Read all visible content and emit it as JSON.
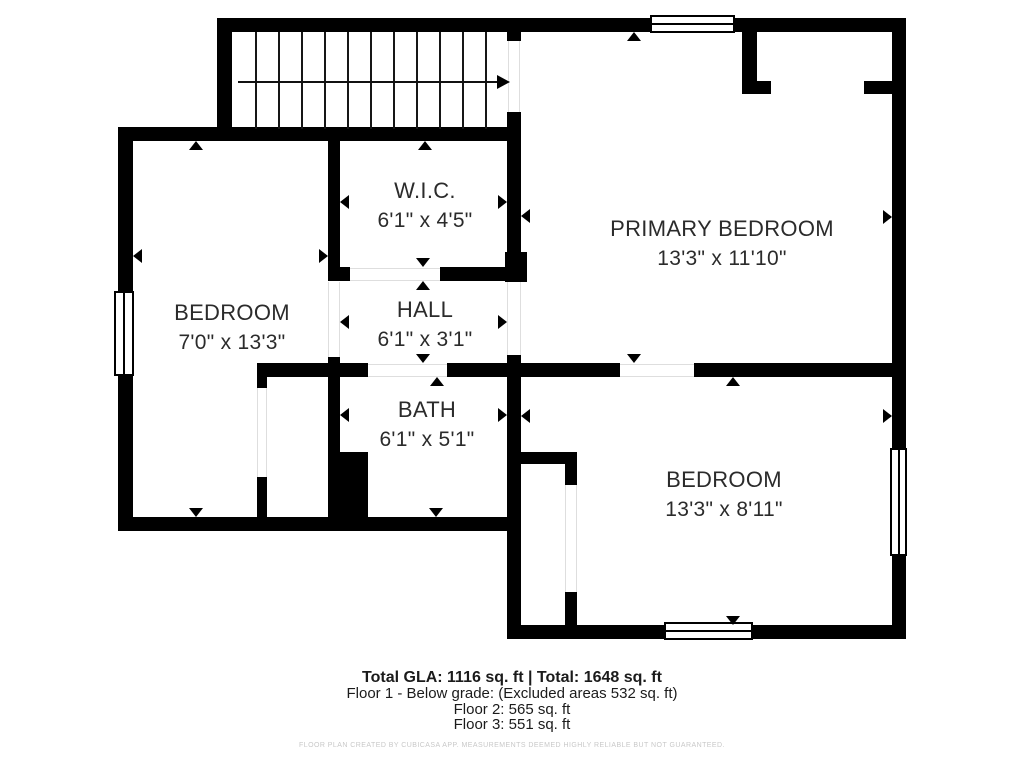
{
  "plan": {
    "rooms": [
      {
        "name": "W.I.C.",
        "dims": "6'1\" x 4'5\"",
        "cx": 425,
        "cy": 176
      },
      {
        "name": "PRIMARY BEDROOM",
        "dims": "13'3\" x 11'10\"",
        "cx": 722,
        "cy": 214
      },
      {
        "name": "BEDROOM",
        "dims": "7'0\" x 13'3\"",
        "cx": 232,
        "cy": 298
      },
      {
        "name": "HALL",
        "dims": "6'1\" x 3'1\"",
        "cx": 425,
        "cy": 295
      },
      {
        "name": "BATH",
        "dims": "6'1\" x 5'1\"",
        "cx": 427,
        "cy": 395
      },
      {
        "name": "BEDROOM",
        "dims": "13'3\" x 8'11\"",
        "cx": 724,
        "cy": 465
      }
    ],
    "walls": [
      {
        "x": 217,
        "y": 18,
        "w": 689,
        "h": 14
      },
      {
        "x": 892,
        "y": 18,
        "w": 14,
        "h": 621
      },
      {
        "x": 217,
        "y": 18,
        "w": 15,
        "h": 123
      },
      {
        "x": 118,
        "y": 127,
        "w": 392,
        "h": 14
      },
      {
        "x": 118,
        "y": 127,
        "w": 15,
        "h": 404
      },
      {
        "x": 118,
        "y": 517,
        "w": 402,
        "h": 14
      },
      {
        "x": 328,
        "y": 141,
        "w": 12,
        "h": 126
      },
      {
        "x": 328,
        "y": 267,
        "w": 22,
        "h": 14
      },
      {
        "x": 440,
        "y": 267,
        "w": 67,
        "h": 14
      },
      {
        "x": 505,
        "y": 252,
        "w": 22,
        "h": 30
      },
      {
        "x": 507,
        "y": 112,
        "w": 14,
        "h": 140
      },
      {
        "x": 507,
        "y": 32,
        "w": 14,
        "h": 9
      },
      {
        "x": 328,
        "y": 357,
        "w": 12,
        "h": 161
      },
      {
        "x": 328,
        "y": 452,
        "w": 40,
        "h": 66
      },
      {
        "x": 257,
        "y": 363,
        "w": 111,
        "h": 14
      },
      {
        "x": 257,
        "y": 363,
        "w": 10,
        "h": 25
      },
      {
        "x": 257,
        "y": 477,
        "w": 10,
        "h": 40
      },
      {
        "x": 447,
        "y": 363,
        "w": 75,
        "h": 14
      },
      {
        "x": 521,
        "y": 363,
        "w": 99,
        "h": 14
      },
      {
        "x": 694,
        "y": 363,
        "w": 198,
        "h": 14
      },
      {
        "x": 507,
        "y": 355,
        "w": 14,
        "h": 284
      },
      {
        "x": 518,
        "y": 452,
        "w": 59,
        "h": 12
      },
      {
        "x": 565,
        "y": 452,
        "w": 12,
        "h": 33
      },
      {
        "x": 565,
        "y": 592,
        "w": 12,
        "h": 47
      },
      {
        "x": 507,
        "y": 625,
        "w": 399,
        "h": 14
      },
      {
        "x": 742,
        "y": 32,
        "w": 15,
        "h": 50
      },
      {
        "x": 742,
        "y": 81,
        "w": 29,
        "h": 13
      },
      {
        "x": 864,
        "y": 81,
        "w": 28,
        "h": 13
      }
    ],
    "windows": [
      {
        "x": 650,
        "y": 15,
        "w": 85,
        "h": 18,
        "o": "h"
      },
      {
        "x": 114,
        "y": 291,
        "w": 20,
        "h": 85,
        "o": "v"
      },
      {
        "x": 890,
        "y": 448,
        "w": 17,
        "h": 108,
        "o": "v"
      },
      {
        "x": 664,
        "y": 622,
        "w": 89,
        "h": 18,
        "o": "h"
      }
    ],
    "openings": [
      {
        "x": 508,
        "y": 41,
        "w": 12,
        "h": 71,
        "o": "v"
      },
      {
        "x": 507,
        "y": 282,
        "w": 14,
        "h": 73,
        "o": "v"
      },
      {
        "x": 350,
        "y": 268,
        "w": 90,
        "h": 13,
        "o": "h"
      },
      {
        "x": 368,
        "y": 364,
        "w": 79,
        "h": 13,
        "o": "h"
      },
      {
        "x": 328,
        "y": 282,
        "w": 12,
        "h": 75,
        "o": "v"
      },
      {
        "x": 257,
        "y": 388,
        "w": 10,
        "h": 89,
        "o": "v"
      },
      {
        "x": 565,
        "y": 485,
        "w": 12,
        "h": 107,
        "o": "v"
      },
      {
        "x": 620,
        "y": 364,
        "w": 74,
        "h": 13,
        "o": "h"
      }
    ],
    "markers": [
      {
        "x": 196,
        "y": 141,
        "d": "up"
      },
      {
        "x": 133,
        "y": 256,
        "d": "left"
      },
      {
        "x": 328,
        "y": 256,
        "d": "right"
      },
      {
        "x": 196,
        "y": 517,
        "d": "down"
      },
      {
        "x": 425,
        "y": 141,
        "d": "up"
      },
      {
        "x": 340,
        "y": 202,
        "d": "left"
      },
      {
        "x": 507,
        "y": 202,
        "d": "right"
      },
      {
        "x": 423,
        "y": 267,
        "d": "down"
      },
      {
        "x": 423,
        "y": 281,
        "d": "up"
      },
      {
        "x": 340,
        "y": 322,
        "d": "left"
      },
      {
        "x": 507,
        "y": 322,
        "d": "right"
      },
      {
        "x": 423,
        "y": 363,
        "d": "down"
      },
      {
        "x": 437,
        "y": 377,
        "d": "up"
      },
      {
        "x": 340,
        "y": 415,
        "d": "left"
      },
      {
        "x": 507,
        "y": 415,
        "d": "right"
      },
      {
        "x": 436,
        "y": 517,
        "d": "down"
      },
      {
        "x": 634,
        "y": 32,
        "d": "up"
      },
      {
        "x": 521,
        "y": 216,
        "d": "left"
      },
      {
        "x": 892,
        "y": 217,
        "d": "right"
      },
      {
        "x": 634,
        "y": 363,
        "d": "down"
      },
      {
        "x": 733,
        "y": 377,
        "d": "up"
      },
      {
        "x": 521,
        "y": 416,
        "d": "left"
      },
      {
        "x": 892,
        "y": 416,
        "d": "right"
      },
      {
        "x": 733,
        "y": 625,
        "d": "down"
      }
    ],
    "stairs": {
      "x": 232,
      "y": 32,
      "w": 276,
      "h": 97,
      "treads": 12,
      "arrow_x1": 238,
      "arrow_x2": 497,
      "arrow_y": 82
    }
  },
  "footer": {
    "summary": "Total GLA: 1116 sq. ft | Total: 1648 sq. ft",
    "floor1": "Floor 1 - Below grade: (Excluded areas 532 sq. ft)",
    "floor2": "Floor 2: 565 sq. ft",
    "floor3": "Floor 3: 551 sq. ft",
    "disclaimer": "FLOOR PLAN CREATED BY CUBICASA APP. MEASUREMENTS DEEMED HIGHLY RELIABLE BUT NOT GUARANTEED."
  }
}
